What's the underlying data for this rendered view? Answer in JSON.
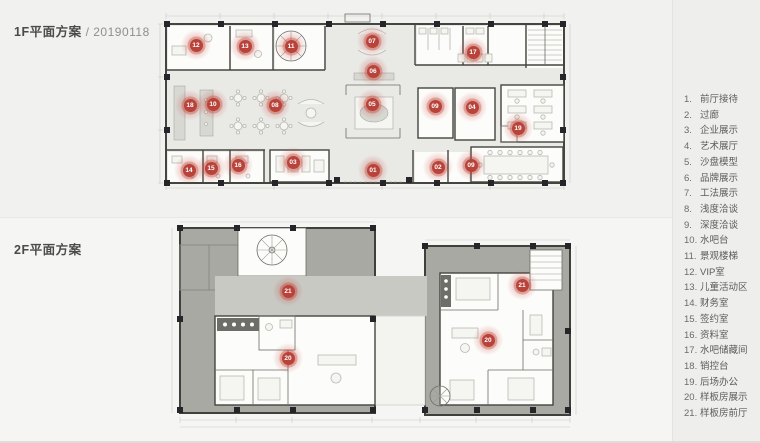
{
  "sections": {
    "floor1": {
      "title": "1F平面方案",
      "date": "/ 20190118"
    },
    "floor2": {
      "title": "2F平面方案"
    }
  },
  "legend": {
    "items": [
      {
        "num": "1.",
        "label": "前厅接待"
      },
      {
        "num": "2.",
        "label": "过廊"
      },
      {
        "num": "3.",
        "label": "企业展示"
      },
      {
        "num": "4.",
        "label": "艺术展厅"
      },
      {
        "num": "5.",
        "label": "沙盘模型"
      },
      {
        "num": "6.",
        "label": "品牌展示"
      },
      {
        "num": "7.",
        "label": "工法展示"
      },
      {
        "num": "8.",
        "label": "浅度洽谈"
      },
      {
        "num": "9.",
        "label": "深度洽谈"
      },
      {
        "num": "10.",
        "label": "水吧台"
      },
      {
        "num": "11.",
        "label": "景观楼梯"
      },
      {
        "num": "12.",
        "label": "VIP室"
      },
      {
        "num": "13.",
        "label": "儿童活动区"
      },
      {
        "num": "14.",
        "label": "财务室"
      },
      {
        "num": "15.",
        "label": "签约室"
      },
      {
        "num": "16.",
        "label": "资料室"
      },
      {
        "num": "17.",
        "label": "水吧储藏间"
      },
      {
        "num": "18.",
        "label": "销控台"
      },
      {
        "num": "19.",
        "label": "后场办公"
      },
      {
        "num": "20.",
        "label": "样板房展示"
      },
      {
        "num": "21.",
        "label": "样板房前厅"
      }
    ]
  },
  "markers": {
    "color": "#b8433a",
    "floor1": [
      {
        "label": "12",
        "x": 38,
        "y": 35
      },
      {
        "label": "13",
        "x": 87,
        "y": 36
      },
      {
        "label": "11",
        "x": 133,
        "y": 36
      },
      {
        "label": "07",
        "x": 214,
        "y": 31
      },
      {
        "label": "17",
        "x": 315,
        "y": 42
      },
      {
        "label": "18",
        "x": 32,
        "y": 95
      },
      {
        "label": "10",
        "x": 55,
        "y": 94
      },
      {
        "label": "08",
        "x": 117,
        "y": 95
      },
      {
        "label": "06",
        "x": 215,
        "y": 61
      },
      {
        "label": "05",
        "x": 214,
        "y": 94
      },
      {
        "label": "09",
        "x": 277,
        "y": 96
      },
      {
        "label": "04",
        "x": 314,
        "y": 97
      },
      {
        "label": "19",
        "x": 360,
        "y": 118
      },
      {
        "label": "14",
        "x": 31,
        "y": 160
      },
      {
        "label": "15",
        "x": 53,
        "y": 158
      },
      {
        "label": "16",
        "x": 80,
        "y": 155
      },
      {
        "label": "03",
        "x": 135,
        "y": 152
      },
      {
        "label": "01",
        "x": 215,
        "y": 160
      },
      {
        "label": "02",
        "x": 280,
        "y": 157
      },
      {
        "label": "09",
        "x": 313,
        "y": 155
      }
    ],
    "floor2": [
      {
        "label": "21",
        "x": 120,
        "y": 71
      },
      {
        "label": "20",
        "x": 120,
        "y": 138
      },
      {
        "label": "21",
        "x": 354,
        "y": 65
      },
      {
        "label": "20",
        "x": 320,
        "y": 120
      }
    ]
  }
}
